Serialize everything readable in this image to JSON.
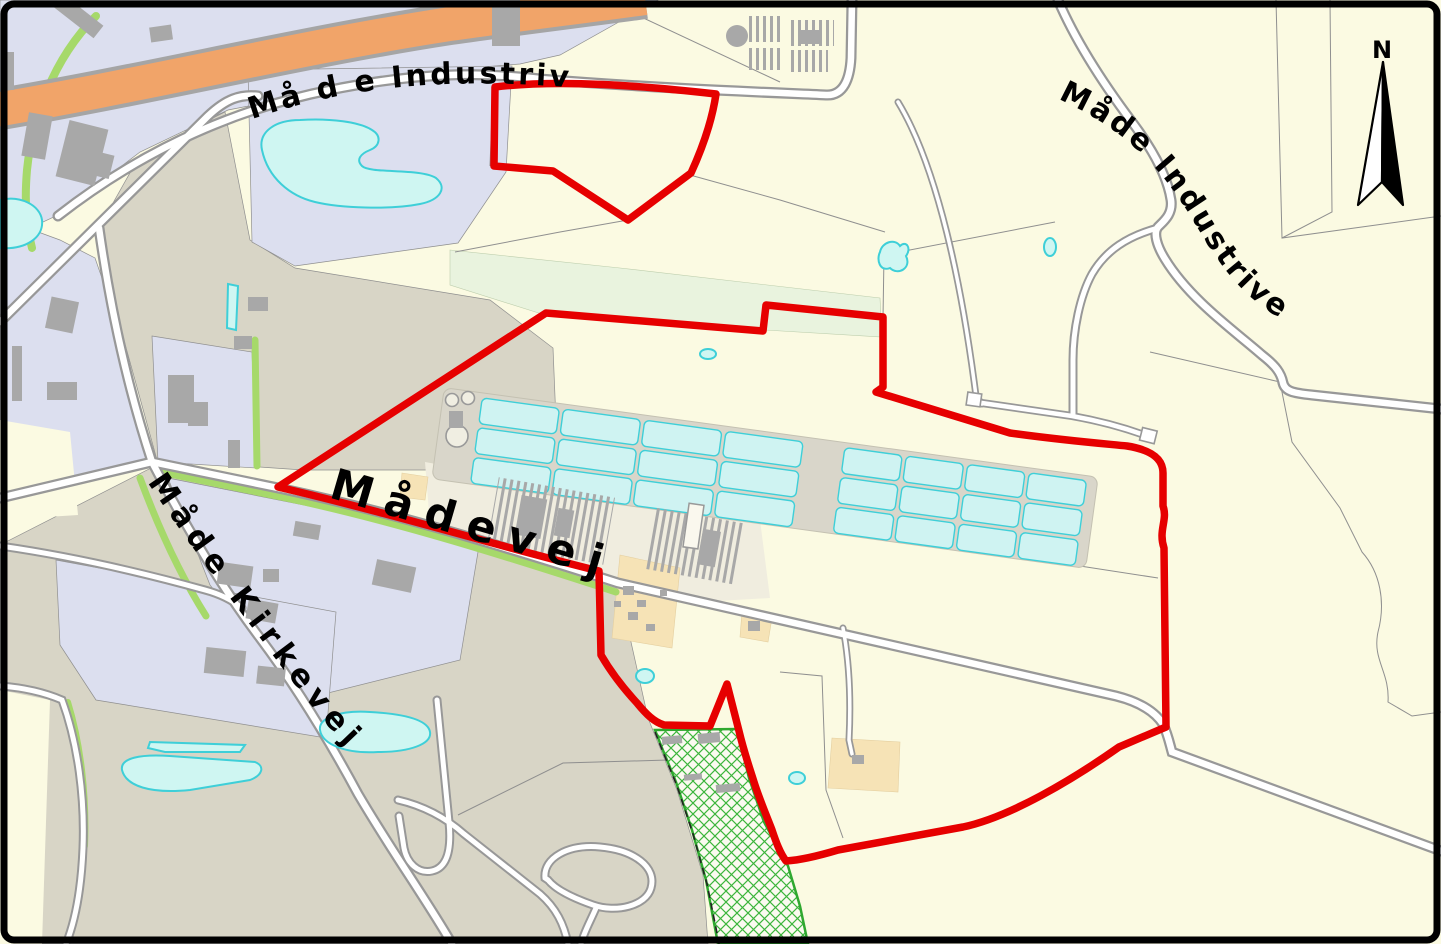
{
  "map": {
    "labels": {
      "road_nw": "Må d e Industrivej",
      "road_ne": "Måde Industrivej",
      "road_center": "Mådevej",
      "road_sw": "Måde Kirkevej"
    },
    "compass": {
      "north_label": "N"
    },
    "colors": {
      "background": "#FBFAE2",
      "rural-area": "#D8D5C6",
      "built-area": "#DCDFEF",
      "yard-area": "#F0EDDF",
      "green-tint-area": "#E9F3DE",
      "water-fill": "#CFF6F2",
      "water-border": "#3ECFD8",
      "basin-fill": "#CFF3F2",
      "road-fill": "#FFFFFF",
      "road-casing": "#989898",
      "highway-fill": "#F1A469",
      "green-strip": "#A6D96A",
      "hatch-green": "#2FA82F",
      "building": "#A8A8A8",
      "tan-parcel": "#F6E3B6",
      "boundary-red": "#E60000",
      "parcel-line": "#8F8F8F",
      "label-text": "#000000",
      "frame": "#000000"
    }
  }
}
